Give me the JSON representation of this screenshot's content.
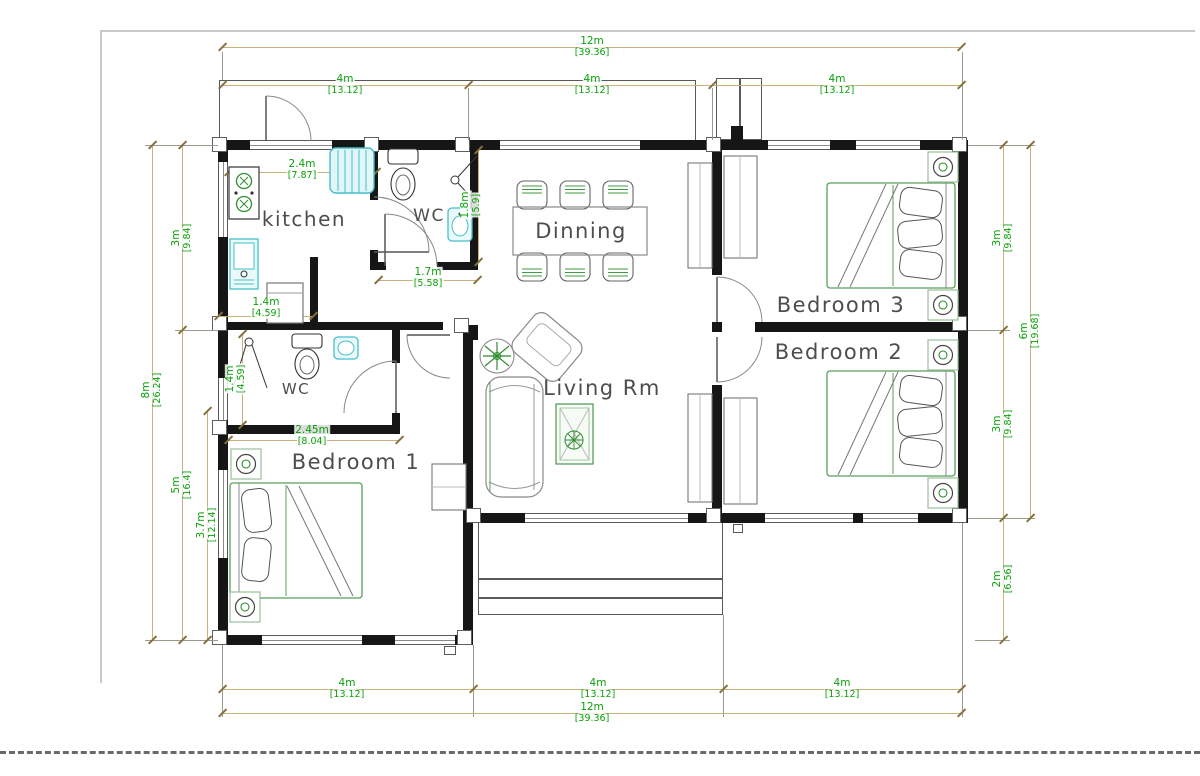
{
  "meta": {
    "type": "architectural-floor-plan",
    "units": "meters-over-feet"
  },
  "colors": {
    "dimension_text": "#0aa10a",
    "dimension_line": "#c7b27c",
    "wall": "#161616",
    "fixture_teal": "#45bfc9",
    "furniture_green": "#3f9b3f"
  },
  "rooms": {
    "kitchen": "kitchen",
    "wc_top": "WC",
    "dining": "Dinning",
    "bedroom3": "Bedroom 3",
    "bedroom2": "Bedroom 2",
    "living": "Living Rm",
    "wc_bottom": "WC",
    "bedroom1": "Bedroom 1"
  },
  "dims": {
    "d12": {
      "m": "12m",
      "ft": "[39.36]"
    },
    "d4": {
      "m": "4m",
      "ft": "[13.12]"
    },
    "d3": {
      "m": "3m",
      "ft": "[9.84]"
    },
    "d8": {
      "m": "8m",
      "ft": "[26.24]"
    },
    "d5": {
      "m": "5m",
      "ft": "[16.4]"
    },
    "d37": {
      "m": "3.7m",
      "ft": "[12.14]"
    },
    "d6": {
      "m": "6m",
      "ft": "[19.68]"
    },
    "d2": {
      "m": "2m",
      "ft": "[6.56]"
    },
    "d24": {
      "m": "2.4m",
      "ft": "[7.87]"
    },
    "d17": {
      "m": "1.7m",
      "ft": "[5.58]"
    },
    "d18": {
      "m": "1.8m",
      "ft": "[5.9]"
    },
    "d14": {
      "m": "1.4m",
      "ft": "[4.59]"
    },
    "d245": {
      "m": "2.45m",
      "ft": "[8.04]"
    }
  }
}
